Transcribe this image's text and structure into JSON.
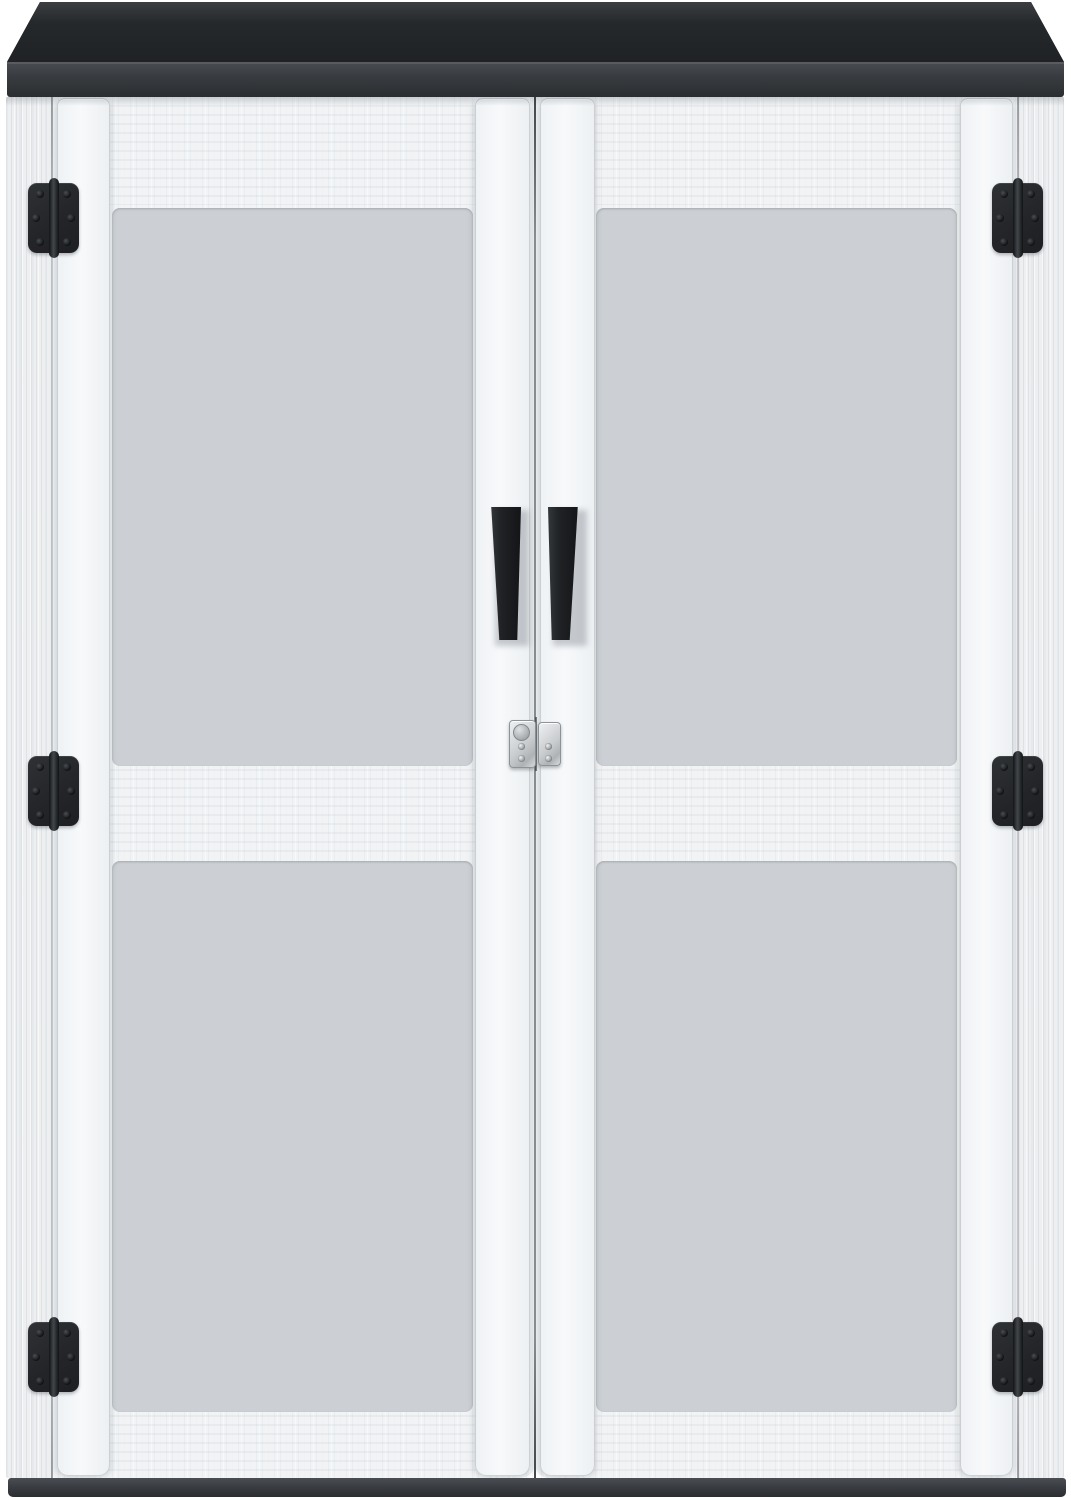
{
  "scene": {
    "type": "product-photo",
    "subject": "White double-door vertical outdoor storage cabinet with dark gray plank lid",
    "background_color": "#ffffff"
  },
  "cabinet": {
    "roof": {
      "plank_count": 15,
      "face_color": "#3f4347",
      "groove_color": "#26292c",
      "fascia_top_color": "#474b4f",
      "fascia_bottom_color": "#2b2e31"
    },
    "body": {
      "door_count": 2,
      "door_color": "#f1f3f5",
      "frame_color": "#edeff1",
      "stile_color": "#f7f9fb",
      "groove_color": "#ccd0d4"
    },
    "panels": {
      "sections_per_door": 2,
      "slats_per_section": 4,
      "slat_color": "#f2f4f6",
      "sections": [
        {
          "id": "door-left-upper-panel"
        },
        {
          "id": "door-left-lower-panel"
        },
        {
          "id": "door-right-upper-panel"
        },
        {
          "id": "door-right-lower-panel"
        }
      ]
    },
    "hinges": {
      "count": 6,
      "color": "#232528",
      "screws_per_hinge": 6,
      "positions": [
        "top-left",
        "middle-left",
        "bottom-left",
        "top-right",
        "middle-right",
        "bottom-right"
      ]
    },
    "handles": {
      "count": 2,
      "color": "#202225",
      "positions": [
        "left-door",
        "right-door"
      ]
    },
    "latch": {
      "type": "silver-hasp-latch",
      "color": "#c9ccce",
      "screw_count": 4,
      "has_knob": true
    },
    "base": {
      "color": "#3a3d41"
    }
  }
}
